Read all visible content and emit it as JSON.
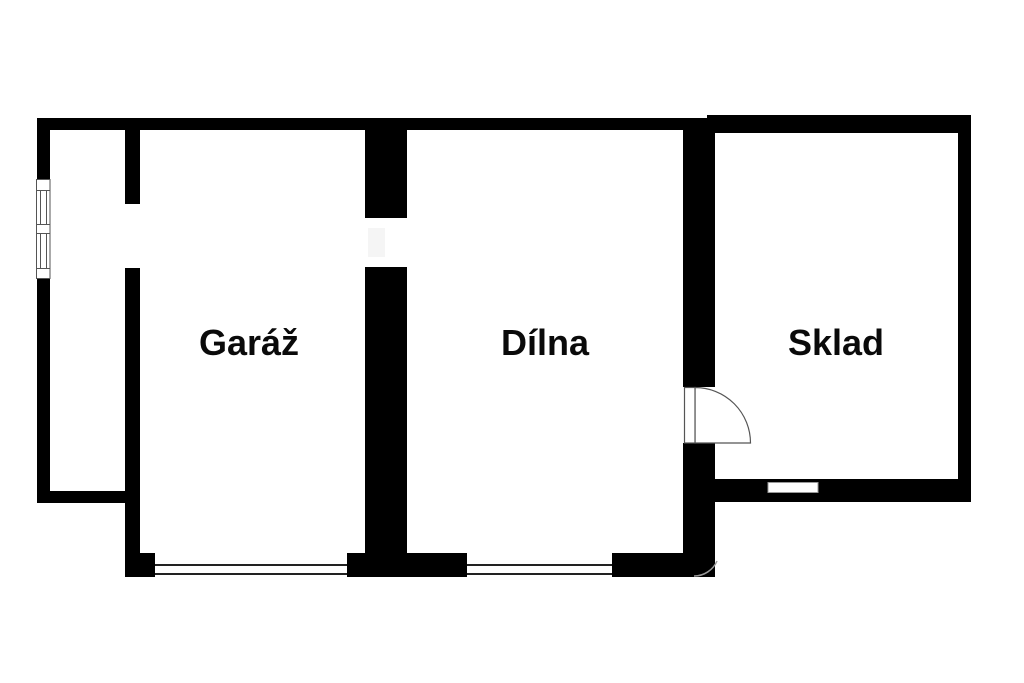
{
  "floor_plan": {
    "rooms": [
      {
        "label": "Garáž"
      },
      {
        "label": "Dílna"
      },
      {
        "label": "Sklad"
      }
    ],
    "colors": {
      "wall": "#000000",
      "background": "#ffffff",
      "symbol_line": "#555555",
      "opening_line": "#222222",
      "faint_line": "#999999",
      "smudge": "#f5f5f5"
    }
  }
}
